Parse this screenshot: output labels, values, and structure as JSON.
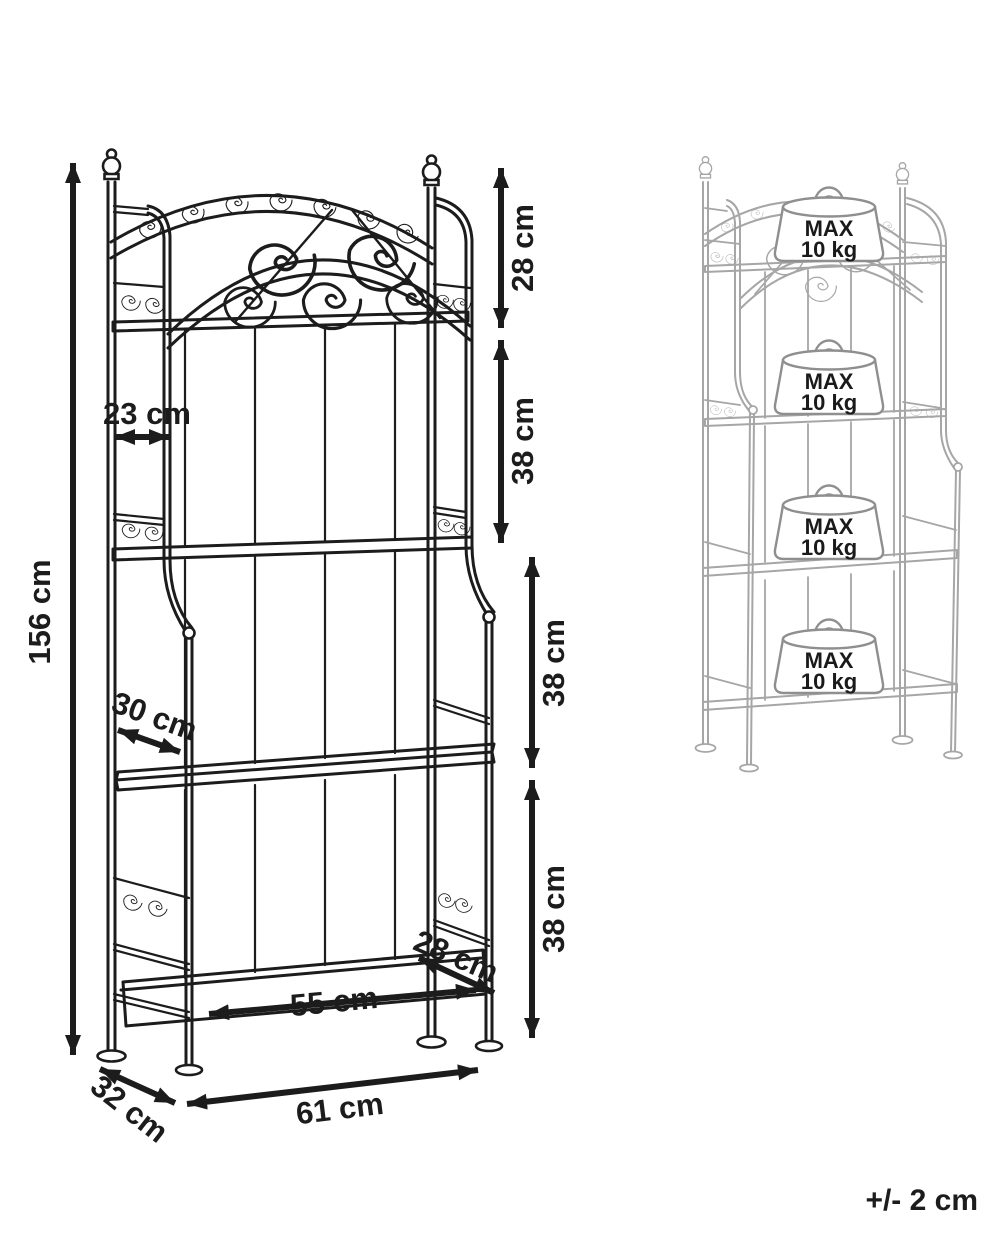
{
  "diagram": {
    "type": "furniture-dimension-diagram",
    "subject": "5-tier ornamental metal shelving rack",
    "colors": {
      "line": "#1c1c1c",
      "ghost_line": "#a6a6a6",
      "weight_outline": "#8f8f8f",
      "text": "#1c1c1c",
      "background": "#ffffff"
    },
    "dimensions": {
      "height": {
        "label": "156 cm"
      },
      "top_tier_gap": {
        "label": "28 cm"
      },
      "tier_gap_1": {
        "label": "38 cm"
      },
      "tier_gap_2": {
        "label": "38 cm"
      },
      "tier_gap_3": {
        "label": "38 cm"
      },
      "top_shelf_depth": {
        "label": "23 cm"
      },
      "middle_shelf_depth": {
        "label": "30 cm"
      },
      "bottom_shelf_width": {
        "label": "55 cm"
      },
      "bottom_shelf_depth": {
        "label": "28 cm"
      },
      "base_width": {
        "label": "61 cm"
      },
      "base_depth": {
        "label": "32 cm"
      }
    },
    "load_view": {
      "weights": [
        {
          "line1": "MAX",
          "line2": "10 kg"
        },
        {
          "line1": "MAX",
          "line2": "10 kg"
        },
        {
          "line1": "MAX",
          "line2": "10 kg"
        },
        {
          "line1": "MAX",
          "line2": "10 kg"
        }
      ]
    },
    "tolerance_note": "+/- 2 cm"
  }
}
